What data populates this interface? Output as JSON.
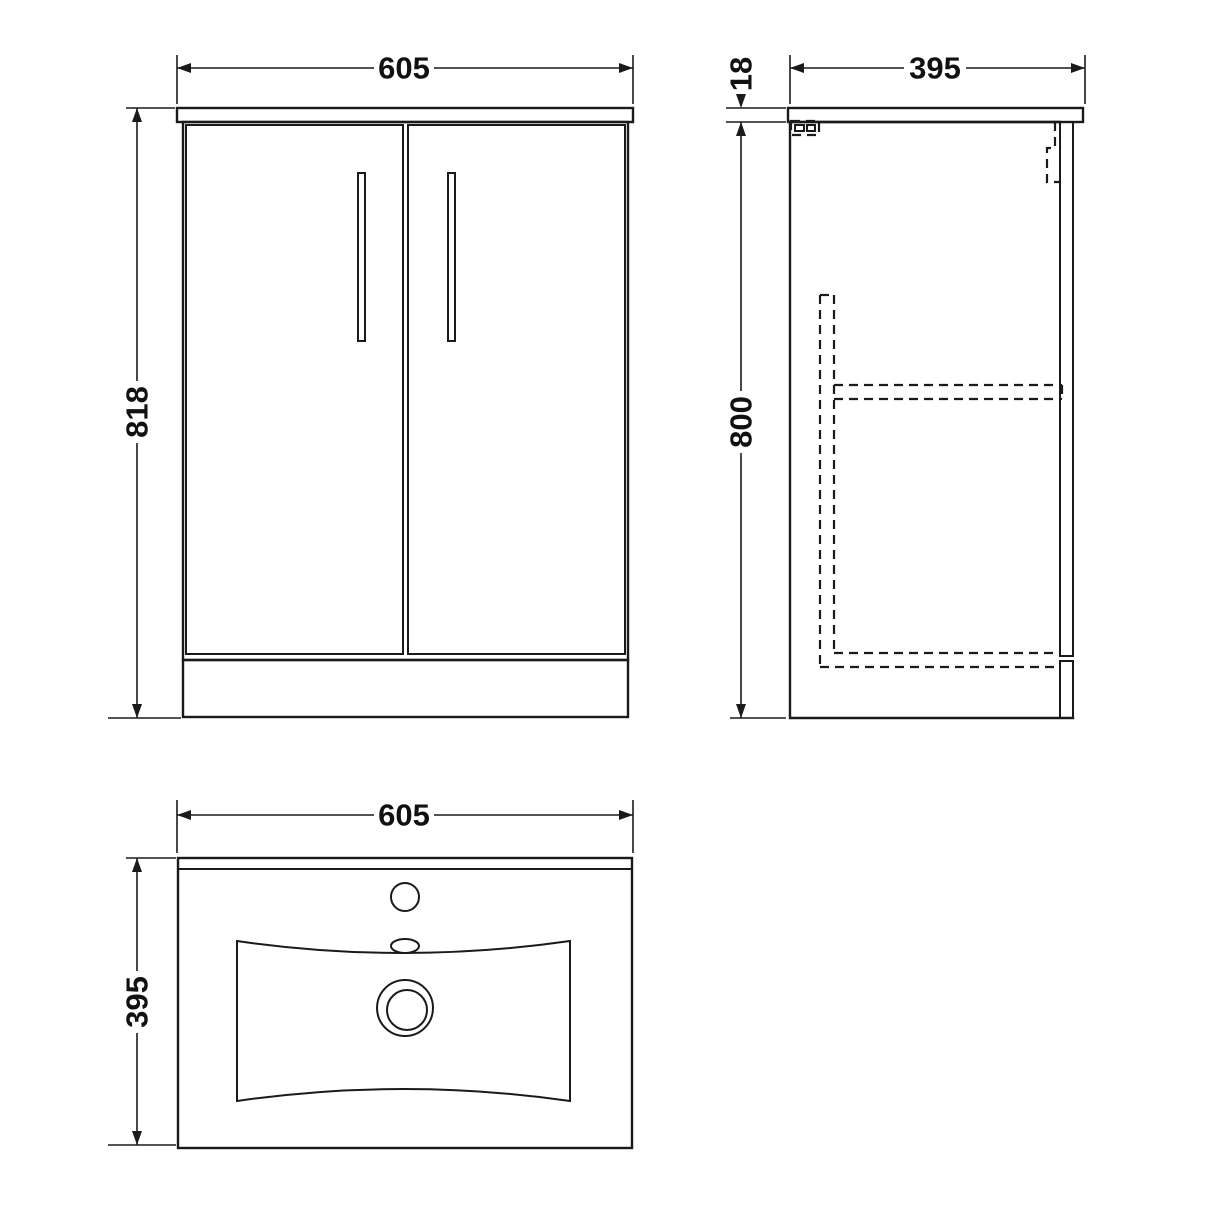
{
  "views": {
    "front": {
      "width": "605",
      "height": "818"
    },
    "side": {
      "depth": "395",
      "worktop_thickness": "18",
      "cabinet_height": "800"
    },
    "plan": {
      "width": "605",
      "depth": "395"
    }
  },
  "colors": {
    "line": "#1a1a1a",
    "background": "#ffffff"
  }
}
